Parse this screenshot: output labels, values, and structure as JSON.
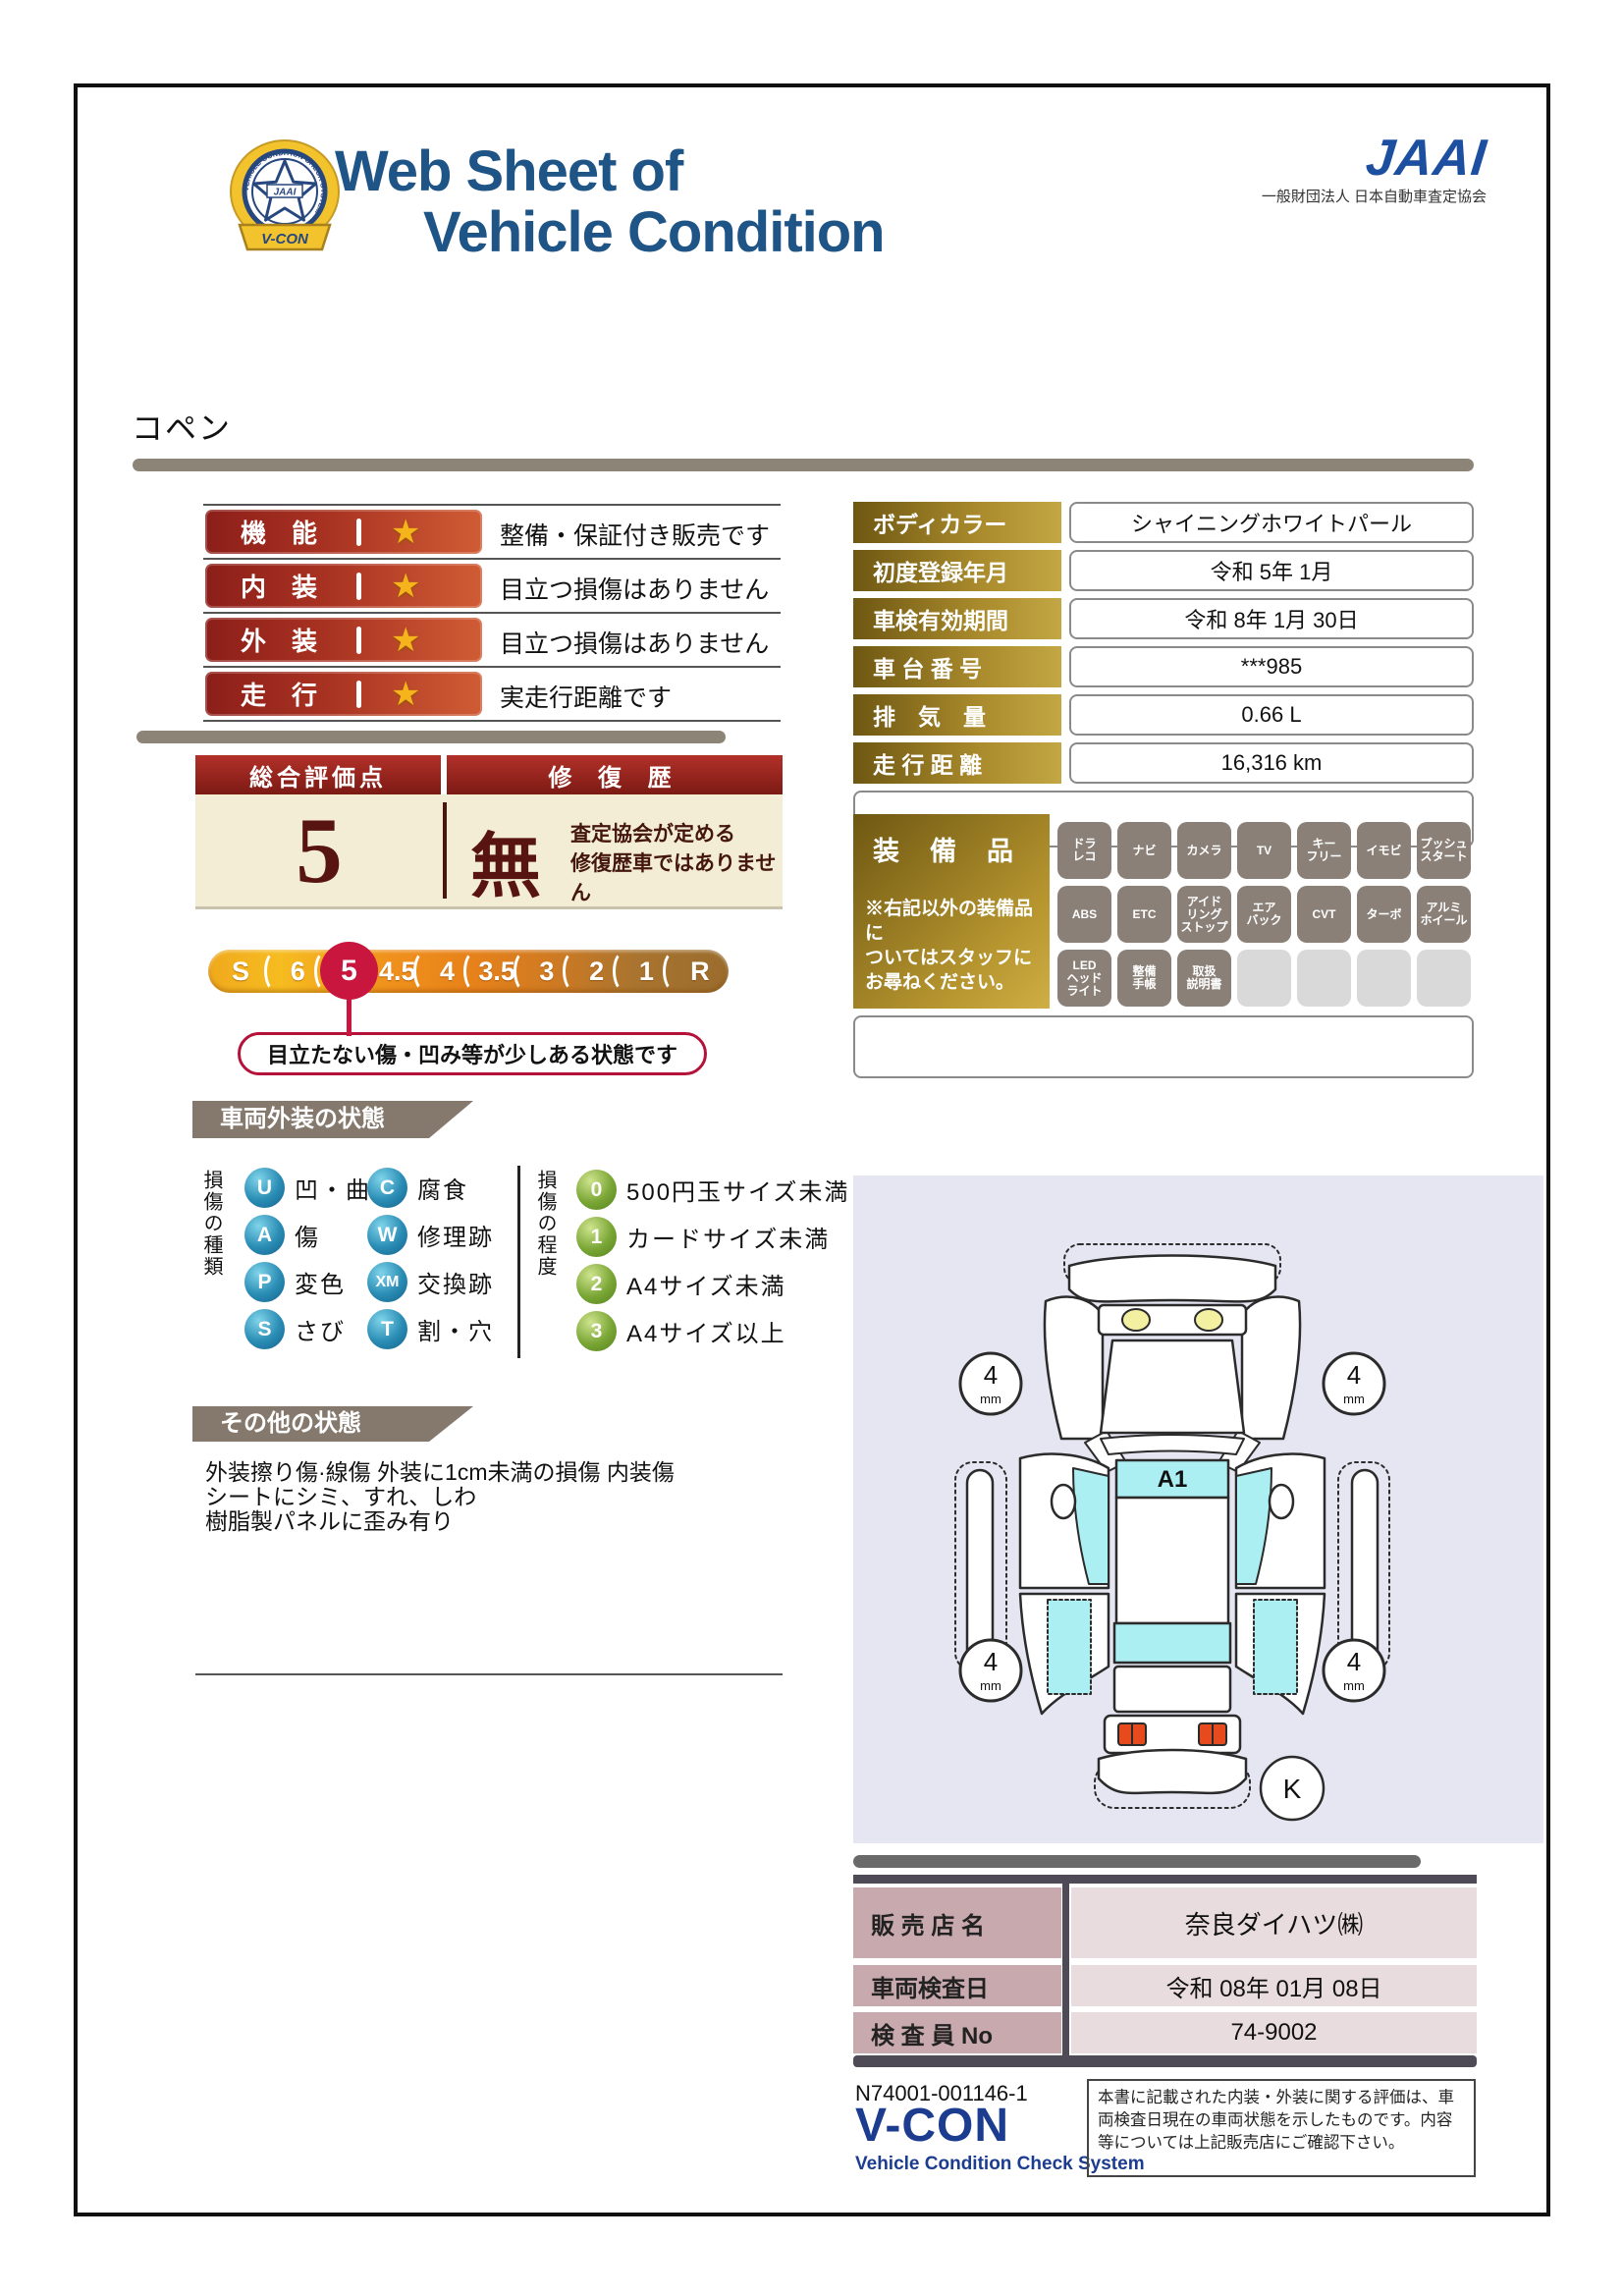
{
  "header": {
    "title_line1": "Web Sheet of",
    "title_line2": "Vehicle Condition",
    "jaai_logo": "JAAI",
    "jaai_org": "一般財団法人 日本自動車査定協会",
    "vcon_badge": {
      "ribbon": "V-CON",
      "ring_text": "VEHICLE CONDITION CHECK SYSTEM",
      "star_text": "JAAI"
    }
  },
  "model_name": "コペン",
  "ratings": [
    {
      "label": "機　能",
      "star": "★",
      "comment": "整備・保証付き販売です"
    },
    {
      "label": "内　装",
      "star": "★",
      "comment": "目立つ損傷はありません"
    },
    {
      "label": "外　装",
      "star": "★",
      "comment": "目立つ損傷はありません"
    },
    {
      "label": "走　行",
      "star": "★",
      "comment": "実走行距離です"
    }
  ],
  "overall": {
    "header_left": "総合評価点",
    "header_right": "修 復 歴",
    "score": "5",
    "repair_history": "無",
    "repair_note_line1": "査定協会が定める",
    "repair_note_line2": "修復歴車ではありません",
    "scale": [
      "S",
      "6",
      "5",
      "4.5",
      "4",
      "3.5",
      "3",
      "2",
      "1",
      "R"
    ],
    "selected": "5",
    "callout": "目立たない傷・凹み等が少しある状態です"
  },
  "vehicle_info": {
    "rows": [
      {
        "label": "ボディカラー",
        "value": "シャイニングホワイトパール"
      },
      {
        "label": "初度登録年月",
        "value": "令和 5年 1月"
      },
      {
        "label": "車検有効期間",
        "value": "令和 8年 1月 30日"
      },
      {
        "label": "車 台 番 号",
        "value": "***985"
      },
      {
        "label": "排　気　量",
        "value": "0.66 L"
      },
      {
        "label": "走 行 距 離",
        "value": "16,316 km"
      }
    ]
  },
  "equipment": {
    "title": "装　備　品",
    "note": "※右記以外の装備品に\nついてはスタッフに\nお尋ねください。",
    "items": [
      "ドラ\nレコ",
      "ナビ",
      "カメラ",
      "TV",
      "キー\nフリー",
      "イモビ",
      "プッシュ\nスタート",
      "ABS",
      "ETC",
      "アイド\nリング\nストップ",
      "エア\nバック",
      "CVT",
      "ターボ",
      "アルミ\nホイール",
      "LED\nヘッド\nライト",
      "整備\n手帳",
      "取扱\n説明書",
      "",
      "",
      "",
      ""
    ]
  },
  "exterior_legend": {
    "title": "車両外装の状態",
    "kind_header": "損傷の種類",
    "kinds": [
      {
        "code": "U",
        "label": "凹・曲"
      },
      {
        "code": "C",
        "label": "腐食"
      },
      {
        "code": "A",
        "label": "傷"
      },
      {
        "code": "W",
        "label": "修理跡"
      },
      {
        "code": "P",
        "label": "変色"
      },
      {
        "code": "XM",
        "label": "交換跡"
      },
      {
        "code": "S",
        "label": "さび"
      },
      {
        "code": "T",
        "label": "割・穴"
      }
    ],
    "degree_header": "損傷の程度",
    "degrees": [
      {
        "code": "0",
        "label": "500円玉サイズ未満"
      },
      {
        "code": "1",
        "label": "カードサイズ未満"
      },
      {
        "code": "2",
        "label": "A4サイズ未満"
      },
      {
        "code": "3",
        "label": "A4サイズ以上"
      }
    ]
  },
  "other_state": {
    "title": "その他の状態",
    "lines": [
      "外装擦り傷·線傷 外装に1cm未満の損傷 内装傷",
      "シートにシミ、すれ、しわ",
      "樹脂製パネルに歪み有り"
    ]
  },
  "diagram": {
    "roof_mark": "A1",
    "tire_depth": "4",
    "tire_unit": "mm",
    "corner_mark": "K"
  },
  "dealer": {
    "rows": [
      {
        "label": "販 売 店 名",
        "value": "奈良ダイハツ㈱"
      },
      {
        "label": "車両検査日",
        "value": "令和 08年 01月 08日"
      },
      {
        "label": "検 査 員 No",
        "value": "74-9002"
      }
    ]
  },
  "footer": {
    "serial": "N74001-001146-1",
    "vcon": "V-CON",
    "vcon_sub": "Vehicle Condition Check System",
    "disclaimer": "本書に記載された内装・外装に関する評価は、車両検査日現在の車両状態を示したものです。内容等については上記販売店にご確認下さい。"
  }
}
